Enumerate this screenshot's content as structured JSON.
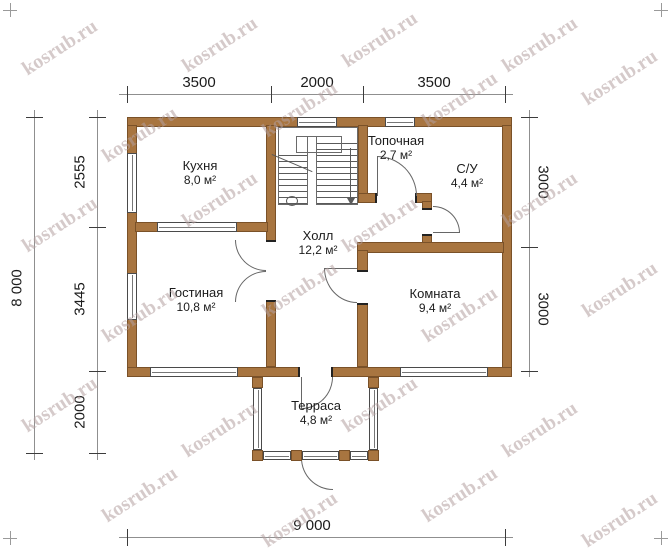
{
  "title": "House floor plan",
  "watermark": {
    "text": "kosrub.ru",
    "positions": [
      [
        60,
        48
      ],
      [
        220,
        45
      ],
      [
        380,
        40
      ],
      [
        540,
        45
      ],
      [
        140,
        135
      ],
      [
        300,
        110
      ],
      [
        460,
        100
      ],
      [
        620,
        78
      ],
      [
        60,
        225
      ],
      [
        220,
        200
      ],
      [
        380,
        225
      ],
      [
        540,
        200
      ],
      [
        140,
        315
      ],
      [
        300,
        290
      ],
      [
        460,
        315
      ],
      [
        620,
        290
      ],
      [
        60,
        405
      ],
      [
        220,
        430
      ],
      [
        380,
        405
      ],
      [
        540,
        430
      ],
      [
        140,
        495
      ],
      [
        300,
        520
      ],
      [
        460,
        495
      ],
      [
        620,
        520
      ]
    ]
  },
  "dimensions": {
    "top": [
      "3500",
      "2000",
      "3500"
    ],
    "left_outer": "8 000",
    "left_inner": [
      "2555",
      "3445",
      "2000"
    ],
    "right": [
      "3000",
      "3000"
    ],
    "bottom": "9 000"
  },
  "rooms": [
    {
      "id": "kitchen",
      "name": "Кухня",
      "area": "8,0 м²"
    },
    {
      "id": "boiler",
      "name": "Топочная",
      "area": "2,7 м²"
    },
    {
      "id": "bathroom",
      "name": "С/У",
      "area": "4,4 м²"
    },
    {
      "id": "hall",
      "name": "Холл",
      "area": "12,2 м²"
    },
    {
      "id": "living",
      "name": "Гостиная",
      "area": "10,8 м²"
    },
    {
      "id": "room",
      "name": "Комната",
      "area": "9,4 м²"
    },
    {
      "id": "terrace",
      "name": "Терраса",
      "area": "4,8 м²"
    }
  ],
  "colors": {
    "wall": "#a87540",
    "wall_border": "#7a5128",
    "dimension_text": "#1c1c1c",
    "watermark": "#b4a0a0",
    "background": "#ffffff"
  }
}
